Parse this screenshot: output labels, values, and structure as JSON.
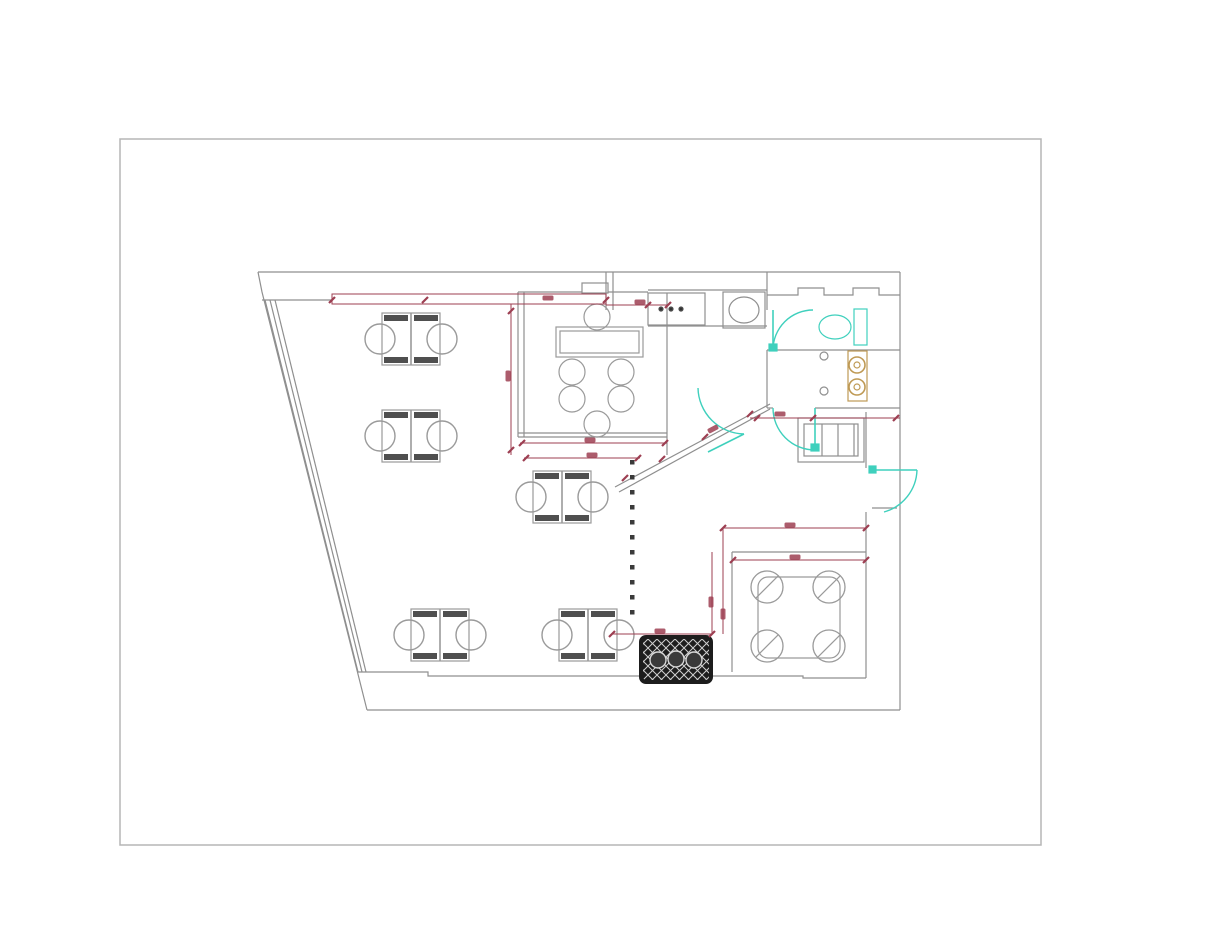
{
  "document": {
    "type": "cad-floor-plan-sheet",
    "canvas": {
      "width": 1214,
      "height": 938,
      "background": "#ffffff"
    },
    "sheet_border": {
      "x": 120,
      "y": 139,
      "w": 921,
      "h": 706,
      "color": "#b5b5b5"
    }
  },
  "palette": {
    "wall": "#8f8f8f",
    "furn": "#9a9a9a",
    "dark": "#4f4f4f",
    "red": "#9d3f52",
    "cyan": "#3fd0bd",
    "tan": "#bf9a55",
    "black": "#1d1d1d",
    "dotfill": "#3a3a3a",
    "white": "#ffffff"
  },
  "plan": {
    "elements": [
      {
        "t": "path",
        "d": "M258,272 H900",
        "name": "wall-top"
      },
      {
        "t": "line",
        "x1": 900,
        "y1": 272,
        "x2": 900,
        "y2": 710,
        "name": "wall-right"
      },
      {
        "t": "line",
        "x1": 367,
        "y1": 710,
        "x2": 900,
        "y2": 710,
        "name": "wall-bottom"
      },
      {
        "t": "path",
        "d": "M258,272 L262,292 L367,710",
        "name": "wall-left-outer"
      },
      {
        "t": "line",
        "x1": 265,
        "y1": 300,
        "x2": 358,
        "y2": 672,
        "name": "wall-left-inner-1"
      },
      {
        "t": "line",
        "x1": 270,
        "y1": 300,
        "x2": 362,
        "y2": 672,
        "name": "wall-left-inner-2"
      },
      {
        "t": "line",
        "x1": 275,
        "y1": 300,
        "x2": 366,
        "y2": 672,
        "name": "wall-left-inner-3"
      },
      {
        "t": "line",
        "x1": 262,
        "y1": 300,
        "x2": 332,
        "y2": 300,
        "name": "wall-top-inner-left"
      },
      {
        "t": "path",
        "d": "M357,672 H428 L428,676 H803 L803,678 H866",
        "name": "floor-inner-edge"
      },
      {
        "t": "line",
        "x1": 866,
        "y1": 412,
        "x2": 866,
        "y2": 468,
        "name": "vestibule-wall-upper"
      },
      {
        "t": "line",
        "x1": 866,
        "y1": 512,
        "x2": 866,
        "y2": 678,
        "name": "vestibule-wall-lower"
      },
      {
        "t": "line",
        "x1": 872,
        "y1": 508,
        "x2": 897,
        "y2": 508,
        "name": "vestibule-sill"
      },
      {
        "t": "line",
        "x1": 732,
        "y1": 552,
        "x2": 866,
        "y2": 552,
        "name": "platform-top-edge"
      },
      {
        "t": "line",
        "x1": 732,
        "y1": 552,
        "x2": 732,
        "y2": 672,
        "name": "platform-left-edge"
      },
      {
        "t": "line",
        "x1": 518,
        "y1": 292,
        "x2": 518,
        "y2": 437,
        "name": "dining-wall-left-a"
      },
      {
        "t": "line",
        "x1": 524,
        "y1": 292,
        "x2": 524,
        "y2": 437,
        "name": "dining-wall-left-b"
      },
      {
        "t": "line",
        "x1": 518,
        "y1": 433,
        "x2": 667,
        "y2": 433,
        "name": "dining-wall-bottom-a"
      },
      {
        "t": "line",
        "x1": 518,
        "y1": 437,
        "x2": 667,
        "y2": 437,
        "name": "dining-wall-bottom-b"
      },
      {
        "t": "line",
        "x1": 518,
        "y1": 292,
        "x2": 582,
        "y2": 292,
        "name": "dining-wall-top-a"
      },
      {
        "t": "line",
        "x1": 608,
        "y1": 292,
        "x2": 648,
        "y2": 292,
        "name": "dining-wall-top-b"
      },
      {
        "t": "rect",
        "x": 582,
        "y": 283,
        "w": 26,
        "h": 10,
        "name": "top-wall-pillar"
      },
      {
        "t": "line",
        "x1": 606,
        "y1": 272,
        "x2": 606,
        "y2": 310,
        "name": "mullion-a"
      },
      {
        "t": "line",
        "x1": 613,
        "y1": 272,
        "x2": 613,
        "y2": 310,
        "name": "mullion-b"
      },
      {
        "t": "line",
        "x1": 667,
        "y1": 293,
        "x2": 667,
        "y2": 455,
        "name": "kitchen-wall-left"
      },
      {
        "t": "line",
        "x1": 648,
        "y1": 290,
        "x2": 767,
        "y2": 290,
        "name": "kitchen-back-line"
      },
      {
        "t": "line",
        "x1": 648,
        "y1": 326,
        "x2": 767,
        "y2": 326,
        "name": "kitchen-counter-front"
      },
      {
        "t": "line",
        "x1": 767,
        "y1": 272,
        "x2": 767,
        "y2": 310,
        "name": "bath-wall-left-upper"
      },
      {
        "t": "line",
        "x1": 767,
        "y1": 350,
        "x2": 767,
        "y2": 408,
        "name": "bath-wall-left-lower"
      },
      {
        "t": "path",
        "d": "M767,295 H798 V288 H824 V295 H853 V288 H879 V295 H900",
        "name": "bath-top-wall-niches"
      },
      {
        "t": "line",
        "x1": 767,
        "y1": 350,
        "x2": 900,
        "y2": 350,
        "name": "bath-divider-wall"
      },
      {
        "t": "line",
        "x1": 767,
        "y1": 408,
        "x2": 773,
        "y2": 408,
        "name": "bath2-bottom-wall-a"
      },
      {
        "t": "line",
        "x1": 815,
        "y1": 408,
        "x2": 900,
        "y2": 408,
        "name": "bath2-bottom-wall-b"
      },
      {
        "t": "line",
        "x1": 770,
        "y1": 404,
        "x2": 615,
        "y2": 487,
        "name": "diagonal-wall-a"
      },
      {
        "t": "line",
        "x1": 770,
        "y1": 409,
        "x2": 619,
        "y2": 492,
        "name": "diagonal-wall-b"
      },
      {
        "t": "rect",
        "x": 798,
        "y": 418,
        "w": 66,
        "h": 44,
        "name": "shelf-unit-outer"
      },
      {
        "t": "rect",
        "x": 804,
        "y": 424,
        "w": 54,
        "h": 32,
        "name": "shelf-unit-inner"
      },
      {
        "t": "line",
        "x1": 822,
        "y1": 424,
        "x2": 822,
        "y2": 456,
        "name": "shelf-slat-1"
      },
      {
        "t": "line",
        "x1": 838,
        "y1": 424,
        "x2": 838,
        "y2": 456,
        "name": "shelf-slat-2"
      },
      {
        "t": "line",
        "x1": 854,
        "y1": 424,
        "x2": 854,
        "y2": 456,
        "name": "shelf-slat-3"
      },
      {
        "t": "circle",
        "cx": 824,
        "cy": 356,
        "r": 4,
        "name": "wall-knob-1"
      },
      {
        "t": "circle",
        "cx": 824,
        "cy": 391,
        "r": 4,
        "name": "wall-knob-2"
      },
      {
        "t": "rect",
        "x": 648,
        "y": 293,
        "w": 57,
        "h": 32,
        "name": "stove-unit"
      },
      {
        "t": "circle",
        "cx": 661,
        "cy": 309,
        "r": 2,
        "f": "#333",
        "c": "dark",
        "name": "stove-burner-1"
      },
      {
        "t": "circle",
        "cx": 671,
        "cy": 309,
        "r": 2,
        "f": "#333",
        "c": "dark",
        "name": "stove-burner-2"
      },
      {
        "t": "circle",
        "cx": 681,
        "cy": 309,
        "r": 2,
        "f": "#333",
        "c": "dark",
        "name": "stove-burner-3"
      },
      {
        "t": "rect",
        "x": 723,
        "y": 292,
        "w": 42,
        "h": 36,
        "name": "kitchen-sink-counter"
      },
      {
        "t": "ellipse",
        "cx": 744,
        "cy": 310,
        "rx": 15,
        "ry": 13,
        "name": "kitchen-sink-basin"
      },
      {
        "t": "ellipse",
        "cx": 835,
        "cy": 327,
        "rx": 16,
        "ry": 12,
        "c": "cyan",
        "name": "toilet-bowl"
      },
      {
        "t": "rect",
        "x": 854,
        "y": 309,
        "w": 13,
        "h": 36,
        "c": "cyan",
        "name": "toilet-tank"
      },
      {
        "t": "line",
        "x1": 773,
        "y1": 310,
        "x2": 773,
        "y2": 350,
        "c": "cyan",
        "w": 1.6,
        "name": "door-leaf-bath1"
      },
      {
        "t": "path",
        "d": "M773,350 A40,40 0 0 1 813,310",
        "c": "cyan",
        "w": 1.4,
        "name": "door-swing-bath1"
      },
      {
        "t": "rect",
        "x": 769,
        "y": 344,
        "w": 8,
        "h": 7,
        "c": "cyan",
        "f": "#3fd0bd",
        "name": "door-hinge-mark-bath1"
      },
      {
        "t": "line",
        "x1": 815,
        "y1": 408,
        "x2": 815,
        "y2": 450,
        "c": "cyan",
        "w": 1.6,
        "name": "door-leaf-bath2"
      },
      {
        "t": "path",
        "d": "M815,450 A42,42 0 0 1 773,408",
        "c": "cyan",
        "w": 1.4,
        "name": "door-swing-bath2"
      },
      {
        "t": "rect",
        "x": 811,
        "y": 444,
        "w": 8,
        "h": 7,
        "c": "cyan",
        "f": "#3fd0bd",
        "name": "door-hinge-mark-bath2"
      },
      {
        "t": "path",
        "d": "M698,388 A47,47 0 0 0 744,434",
        "c": "cyan",
        "w": 1.4,
        "name": "door-swing-diagonal"
      },
      {
        "t": "line",
        "x1": 744,
        "y1": 434,
        "x2": 708,
        "y2": 452,
        "c": "cyan",
        "w": 1.6,
        "name": "door-leaf-diagonal"
      },
      {
        "t": "line",
        "x1": 872,
        "y1": 470,
        "x2": 917,
        "y2": 470,
        "c": "cyan",
        "w": 1.6,
        "name": "door-leaf-entrance"
      },
      {
        "t": "path",
        "d": "M917,470 A45,45 0 0 1 884,512",
        "c": "cyan",
        "w": 1.4,
        "name": "door-swing-entrance"
      },
      {
        "t": "rect",
        "x": 869,
        "y": 466,
        "w": 7,
        "h": 7,
        "c": "cyan",
        "f": "#3fd0bd",
        "name": "door-hinge-mark-entrance"
      },
      {
        "t": "rect",
        "x": 848,
        "y": 351,
        "w": 19,
        "h": 50,
        "c": "tan",
        "name": "washbasin-panel"
      },
      {
        "t": "circle",
        "cx": 857,
        "cy": 365,
        "r": 8,
        "c": "tan",
        "sw": 1.6,
        "name": "washbasin-1"
      },
      {
        "t": "circle",
        "cx": 857,
        "cy": 365,
        "r": 3,
        "c": "tan",
        "name": "washbasin-1-drain"
      },
      {
        "t": "circle",
        "cx": 857,
        "cy": 387,
        "r": 8,
        "c": "tan",
        "sw": 1.6,
        "name": "washbasin-2"
      },
      {
        "t": "circle",
        "cx": 857,
        "cy": 387,
        "r": 3,
        "c": "tan",
        "name": "washbasin-2-drain"
      },
      {
        "t": "rect",
        "x": 556,
        "y": 327,
        "w": 87,
        "h": 30,
        "c": "furn",
        "name": "dining-table-outer"
      },
      {
        "t": "rect",
        "x": 560,
        "y": 331,
        "w": 79,
        "h": 22,
        "c": "furn",
        "name": "dining-table-inner"
      },
      {
        "t": "circle",
        "cx": 597,
        "cy": 317,
        "r": 13,
        "c": "furn",
        "name": "dining-chair-top"
      },
      {
        "t": "circle",
        "cx": 572,
        "cy": 372,
        "r": 13,
        "c": "furn",
        "name": "dining-chair-l1"
      },
      {
        "t": "circle",
        "cx": 621,
        "cy": 372,
        "r": 13,
        "c": "furn",
        "name": "dining-chair-r1"
      },
      {
        "t": "circle",
        "cx": 572,
        "cy": 399,
        "r": 13,
        "c": "furn",
        "name": "dining-chair-l2"
      },
      {
        "t": "circle",
        "cx": 621,
        "cy": 399,
        "r": 13,
        "c": "furn",
        "name": "dining-chair-r2"
      },
      {
        "t": "circle",
        "cx": 597,
        "cy": 424,
        "r": 13,
        "c": "furn",
        "name": "dining-chair-bottom"
      },
      {
        "t": "table2",
        "cx": 411,
        "cy": 339,
        "name": "two-seat-table-1"
      },
      {
        "t": "table2",
        "cx": 411,
        "cy": 436,
        "name": "two-seat-table-2"
      },
      {
        "t": "table2",
        "cx": 562,
        "cy": 497,
        "name": "two-seat-table-3"
      },
      {
        "t": "table2",
        "cx": 440,
        "cy": 635,
        "name": "two-seat-table-4"
      },
      {
        "t": "table2",
        "cx": 588,
        "cy": 635,
        "name": "two-seat-table-5"
      },
      {
        "t": "rect",
        "x": 758,
        "y": 577,
        "w": 82,
        "h": 81,
        "rx": 10,
        "c": "furn",
        "name": "square-table"
      },
      {
        "t": "chair4",
        "cx": 767,
        "cy": 587,
        "r": 16,
        "name": "armchair-1"
      },
      {
        "t": "chair4",
        "cx": 829,
        "cy": 587,
        "r": 16,
        "name": "armchair-2"
      },
      {
        "t": "chair4",
        "cx": 767,
        "cy": 646,
        "r": 16,
        "name": "armchair-3"
      },
      {
        "t": "chair4",
        "cx": 829,
        "cy": 646,
        "r": 16,
        "name": "armchair-4"
      },
      {
        "t": "planter",
        "x": 641,
        "y": 637,
        "w": 70,
        "h": 45,
        "circles": [
          [
            658,
            660
          ],
          [
            676,
            659
          ],
          [
            694,
            660
          ]
        ],
        "name": "planter-box"
      },
      {
        "t": "dots",
        "x": 630,
        "y0": 460,
        "y1": 612,
        "step": 15,
        "s": 4.5,
        "name": "partition-dotted-line"
      },
      {
        "t": "rect",
        "x": 332,
        "y": 294,
        "w": 274,
        "h": 10,
        "c": "red",
        "sw": 1,
        "name": "dim-band-top"
      },
      {
        "t": "line",
        "x1": 606,
        "y1": 305,
        "x2": 668,
        "y2": 305,
        "c": "red",
        "w": 1,
        "name": "dim-top-2"
      },
      {
        "t": "line",
        "x1": 511,
        "y1": 304,
        "x2": 511,
        "y2": 455,
        "c": "red",
        "w": 1,
        "name": "dim-vert-dining"
      },
      {
        "t": "line",
        "x1": 520,
        "y1": 443,
        "x2": 667,
        "y2": 443,
        "c": "red",
        "w": 1,
        "name": "dim-dining-bottom-1"
      },
      {
        "t": "line",
        "x1": 524,
        "y1": 458,
        "x2": 640,
        "y2": 458,
        "c": "red",
        "w": 1,
        "name": "dim-dining-bottom-2"
      },
      {
        "t": "line",
        "x1": 750,
        "y1": 418,
        "x2": 900,
        "y2": 418,
        "c": "red",
        "w": 1,
        "name": "dim-corridor"
      },
      {
        "t": "line",
        "x1": 723,
        "y1": 528,
        "x2": 866,
        "y2": 528,
        "c": "red",
        "w": 1,
        "name": "dim-platform-1"
      },
      {
        "t": "line",
        "x1": 733,
        "y1": 560,
        "x2": 866,
        "y2": 560,
        "c": "red",
        "w": 1,
        "name": "dim-platform-2"
      },
      {
        "t": "line",
        "x1": 723,
        "y1": 528,
        "x2": 723,
        "y2": 634,
        "c": "red",
        "w": 1,
        "name": "dim-platform-vert-1"
      },
      {
        "t": "line",
        "x1": 712,
        "y1": 552,
        "x2": 712,
        "y2": 634,
        "c": "red",
        "w": 1,
        "name": "dim-platform-vert-2"
      },
      {
        "t": "line",
        "x1": 612,
        "y1": 634,
        "x2": 712,
        "y2": 634,
        "c": "red",
        "w": 1,
        "name": "dim-planter"
      },
      {
        "t": "tick",
        "x": 332,
        "y": 300
      },
      {
        "t": "tick",
        "x": 425,
        "y": 300
      },
      {
        "t": "tick",
        "x": 606,
        "y": 300
      },
      {
        "t": "tick",
        "x": 648,
        "y": 305
      },
      {
        "t": "tick",
        "x": 668,
        "y": 305
      },
      {
        "t": "tick",
        "x": 511,
        "y": 311
      },
      {
        "t": "tick",
        "x": 511,
        "y": 450
      },
      {
        "t": "tick",
        "x": 522,
        "y": 443
      },
      {
        "t": "tick",
        "x": 665,
        "y": 443
      },
      {
        "t": "tick",
        "x": 526,
        "y": 458
      },
      {
        "t": "tick",
        "x": 638,
        "y": 458
      },
      {
        "t": "tick",
        "x": 750,
        "y": 414
      },
      {
        "t": "tick",
        "x": 705,
        "y": 437
      },
      {
        "t": "tick",
        "x": 662,
        "y": 459
      },
      {
        "t": "tick",
        "x": 625,
        "y": 478
      },
      {
        "t": "tick",
        "x": 757,
        "y": 418
      },
      {
        "t": "tick",
        "x": 813,
        "y": 418
      },
      {
        "t": "tick",
        "x": 896,
        "y": 418
      },
      {
        "t": "tick",
        "x": 723,
        "y": 528
      },
      {
        "t": "tick",
        "x": 866,
        "y": 528
      },
      {
        "t": "tick",
        "x": 733,
        "y": 560
      },
      {
        "t": "tick",
        "x": 866,
        "y": 560
      },
      {
        "t": "tick",
        "x": 612,
        "y": 634
      },
      {
        "t": "tick",
        "x": 712,
        "y": 634
      },
      {
        "t": "label",
        "x": 548,
        "y": 298
      },
      {
        "t": "label",
        "x": 640,
        "y": 302
      },
      {
        "t": "label",
        "x": 508,
        "y": 376,
        "rot": 90
      },
      {
        "t": "label",
        "x": 590,
        "y": 440
      },
      {
        "t": "label",
        "x": 592,
        "y": 455
      },
      {
        "t": "label",
        "x": 713,
        "y": 429,
        "rot": -28
      },
      {
        "t": "label",
        "x": 780,
        "y": 414
      },
      {
        "t": "label",
        "x": 790,
        "y": 525
      },
      {
        "t": "label",
        "x": 795,
        "y": 557
      },
      {
        "t": "label",
        "x": 711,
        "y": 602,
        "rot": 90
      },
      {
        "t": "label",
        "x": 723,
        "y": 614,
        "rot": 90
      },
      {
        "t": "label",
        "x": 660,
        "y": 631
      }
    ]
  }
}
